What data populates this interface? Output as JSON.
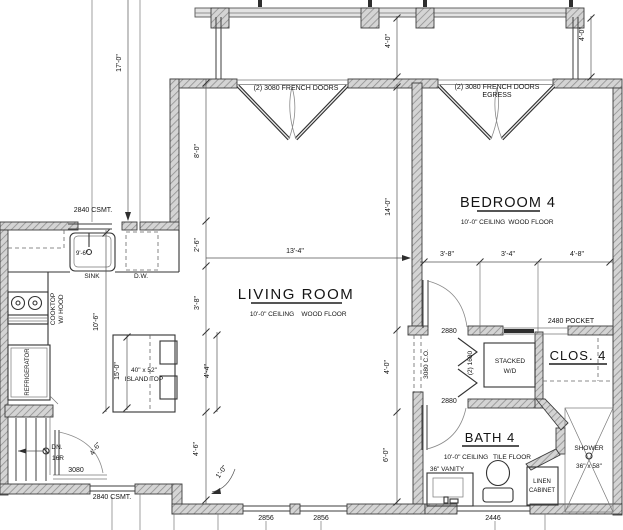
{
  "plan": {
    "rooms": {
      "living": {
        "title": "LIVING ROOM",
        "ceiling": "10'-0\" CEILING",
        "floor": "WOOD FLOOR"
      },
      "bedroom": {
        "title": "BEDROOM 4",
        "ceiling": "10'-0\" CEILING",
        "floor": "WOOD FLOOR"
      },
      "bath": {
        "title": "BATH 4",
        "ceiling": "10'-0\" CEILING",
        "floor": "TILE FLOOR"
      },
      "closet": {
        "title": "CLOS. 4"
      }
    },
    "doors": {
      "french_living": "(2) 3080 FRENCH DOORS",
      "french_bedroom": "(2) 3080 FRENCH DOORS",
      "french_bedroom_note": "EGRESS",
      "entry": "3080",
      "bedroom_door": "2880",
      "bath_door": "2880",
      "pocket": "2480 POCKET",
      "bifold": "(2) 1680",
      "cased_opening": "3080 C.O."
    },
    "windows": {
      "kitchen_north": "2840 CSMT.",
      "kitchen_south": "2840 CSMT.",
      "living_south_1": "2856",
      "living_south_2": "2856",
      "bath_south": "2446"
    },
    "labels": {
      "sink": "SINK",
      "sink_dim": "9'-6\"",
      "dishwasher": "D.W.",
      "cooktop_1": "COOKTOP",
      "cooktop_2": "W/ HOOD",
      "refrigerator": "REFRIGERATOR",
      "island_1": "40\" x 52\"",
      "island_2": "ISLAND TOP",
      "stairs_1": "DN.",
      "stairs_2": "16R",
      "washer_1": "STACKED",
      "washer_2": "W/D",
      "vanity": "36\" VANITY",
      "linen_1": "LINEN",
      "linen_2": "CABINET",
      "shower_1": "SHOWER",
      "shower_2": "36\" x 58\""
    },
    "dimensions": {
      "left_17": "17'-0\"",
      "left_8": "8'-0\"",
      "left_2_6": "2'-6\"",
      "left_3_8": "3'-8\"",
      "left_10_6": "10'-6\"",
      "left_15": "15'-0\"",
      "left_4_4": "4'-4\"",
      "left_4_6": "4'-6\"",
      "door_4_6": "4'-6\"",
      "jog_1_0": "1'-0\"",
      "top_13_4": "13'-4\"",
      "deck_4_0_a": "4'-0\"",
      "deck_4_0_b": "4'-0\"",
      "mid_14_0": "14'-0\"",
      "mid_4_0": "4'-0\"",
      "mid_6_0": "6'-0\"",
      "bed_3_8": "3'-8\"",
      "bed_3_4": "3'-4\"",
      "bed_4_8": "4'-8\""
    },
    "colors": {
      "wall_fill": "#d4d4d4",
      "wall_hatch": "#8f8f8f",
      "line": "#3c3c3c"
    }
  }
}
